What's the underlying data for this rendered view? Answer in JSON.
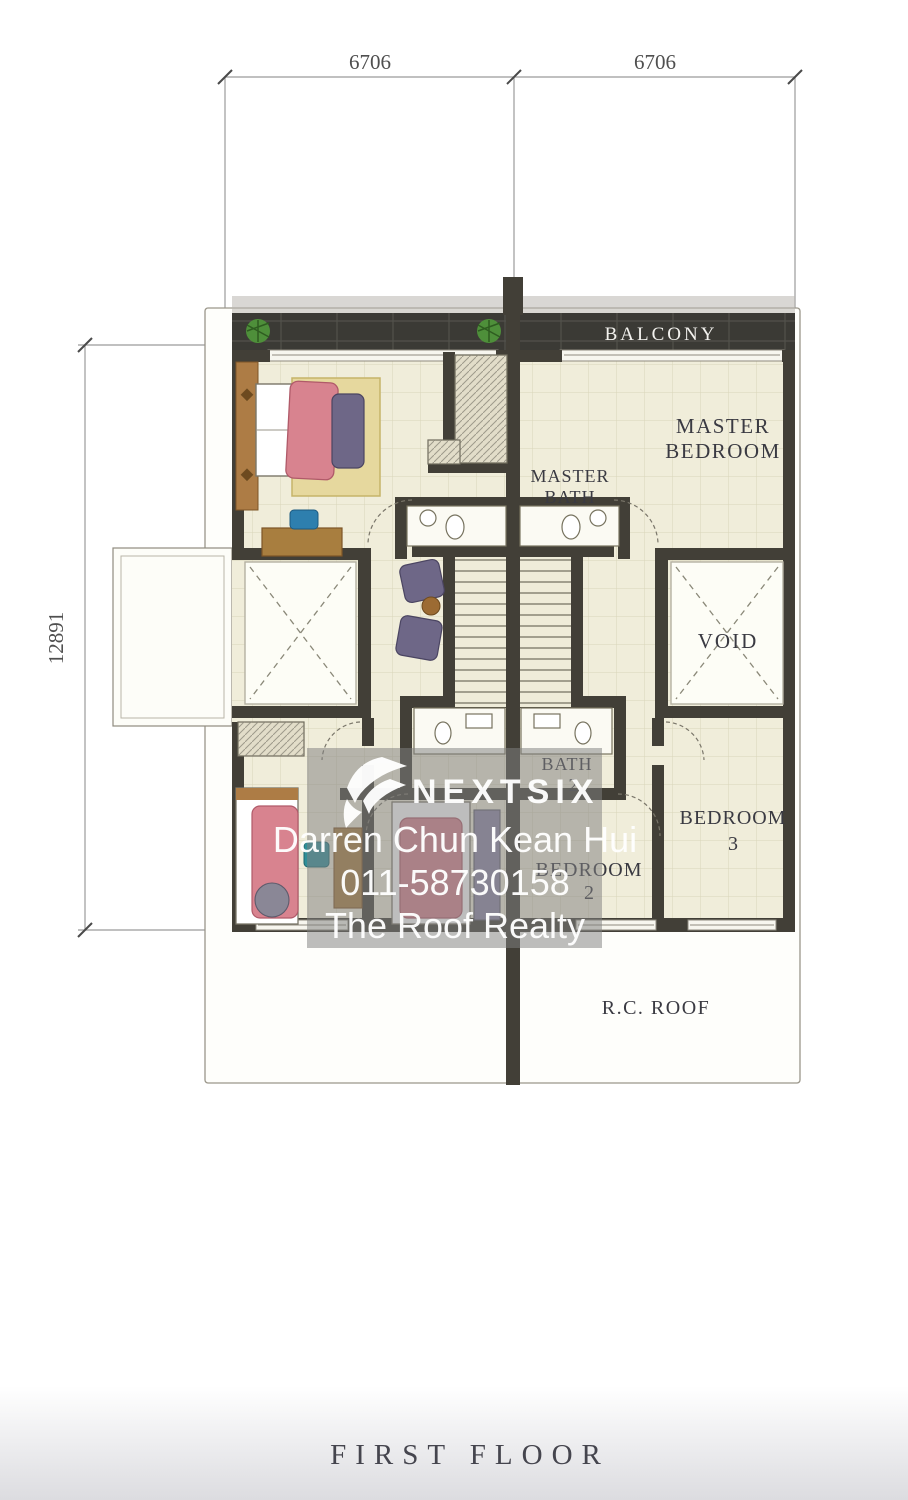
{
  "dimensions": {
    "top_left": "6706",
    "top_right": "6706",
    "side": "12891"
  },
  "plan": {
    "rooms": {
      "balcony": "BALCONY",
      "master_bedroom_l1": "MASTER",
      "master_bedroom_l2": "BEDROOM",
      "master_bath_l1": "MASTER",
      "master_bath_l2": "BATH",
      "void": "VOID",
      "bath2_l1": "BATH",
      "bath2_l2": "2",
      "bedroom2_l1": "BEDROOM",
      "bedroom2_l2": "2",
      "bedroom3_l1": "BEDROOM",
      "bedroom3_l2": "3",
      "rc_roof": "R.C. ROOF"
    },
    "title": "FIRST FLOOR"
  },
  "watermark": {
    "brand": "NEXTSIX",
    "agent": "Darren Chun Kean Hui",
    "phone": "011-58730158",
    "agency": "The Roof Realty"
  },
  "icons": {
    "brand_logo": "nextsix-swoosh-logo",
    "plant": "potted-plant"
  },
  "colors": {
    "wall": "#423f37",
    "floor": "#f0edda",
    "grid": "#c9c4a4",
    "balcony_band": "#3b3a35",
    "bed_pink": "#d8838f",
    "sofa_purple": "#6e6787",
    "rug_yellow": "#e6d89e",
    "wood_brown": "#a87e3f",
    "chair_blue": "#2e7fae",
    "plant_green": "#4e8f3a",
    "overlay_gray": "#808080",
    "label_ink": "#3a3a42"
  }
}
